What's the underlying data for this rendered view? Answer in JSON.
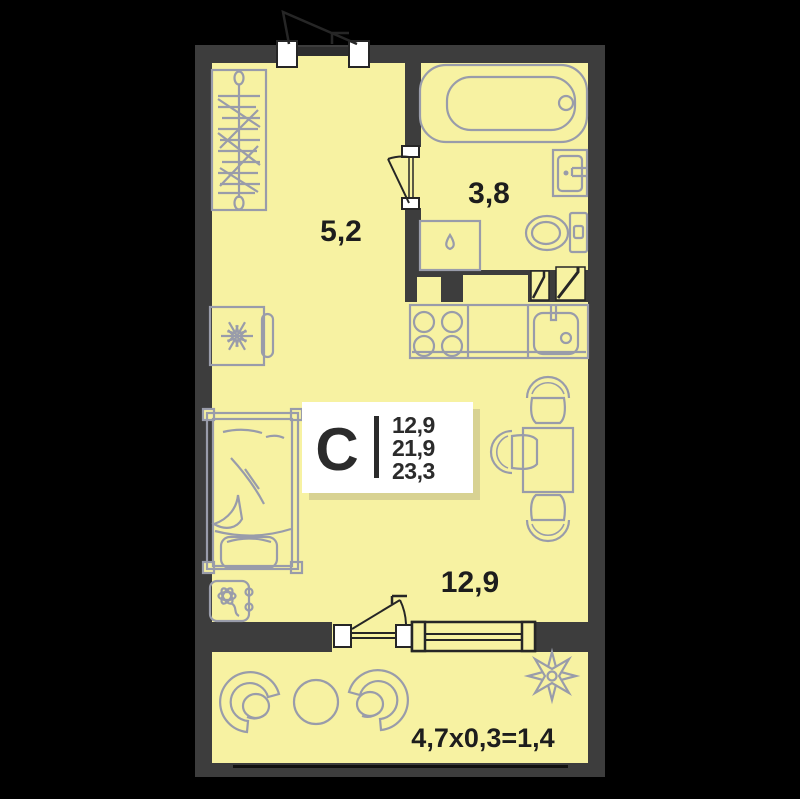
{
  "plan": {
    "unit_label": "С",
    "info_card": {
      "living_area": "12,9",
      "total_area": "21,9",
      "total_area_with_balcony": "23,3"
    },
    "rooms": [
      {
        "id": "hallway",
        "area_label": "5,2"
      },
      {
        "id": "bathroom",
        "area_label": "3,8"
      },
      {
        "id": "living-room",
        "area_label": "12,9"
      },
      {
        "id": "balcony",
        "area_label": "4,7x0,3=1,4"
      }
    ],
    "colors": {
      "background": "#000000",
      "wall": "#3d3d3d",
      "floor": "#f7f2a2",
      "furniture_line": "#999caa",
      "symbol_line": "#262626",
      "text": "#1d1d1d",
      "card_bg": "#ffffff",
      "card_shadow": "#d8d292"
    }
  }
}
